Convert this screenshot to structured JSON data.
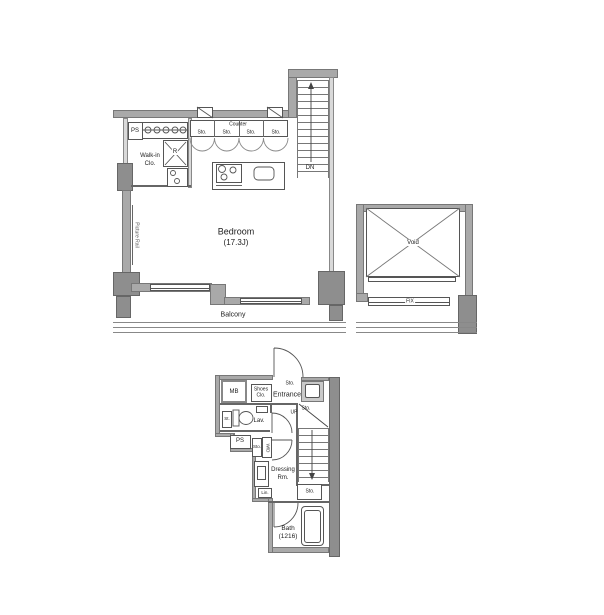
{
  "plan": {
    "colors": {
      "wall": "#a9a9a9",
      "column": "#8e8e8e",
      "line": "#555555",
      "shade": "#c9c9c9",
      "background": "#ffffff"
    },
    "upper": {
      "labels": {
        "ps": "PS",
        "counter": "Counter",
        "sto1": "Sto.",
        "sto2": "Sto.",
        "sto3": "Sto.",
        "sto4": "Sto.",
        "fridge": "R",
        "walkin_line1": "Walk-in",
        "walkin_line2": "Clo.",
        "picture_rail": "Picture Rail",
        "bedroom": "Bedroom",
        "bedroom_size": "(17.3J)",
        "dn": "DN",
        "balcony": "Balcony",
        "void": "Void",
        "fix": "FIX"
      }
    },
    "lower": {
      "labels": {
        "mb": "MB",
        "shoes_line1": "Shoes",
        "shoes_line2": "Clo.",
        "sto_entrance": "Sto.",
        "entrance": "Entrance",
        "up": "UP",
        "sto_stairs_top": "Sto.",
        "st": "St.",
        "lav": "Lav.",
        "ps": "PS",
        "sto_wd": "Sto.",
        "wd": "W/D",
        "dressing_line1": "Dressing",
        "dressing_line2": "Rm.",
        "lin": "Lin.",
        "sto_under_stairs": "Sto.",
        "bath": "Bath",
        "bath_size": "(1216)"
      }
    }
  }
}
